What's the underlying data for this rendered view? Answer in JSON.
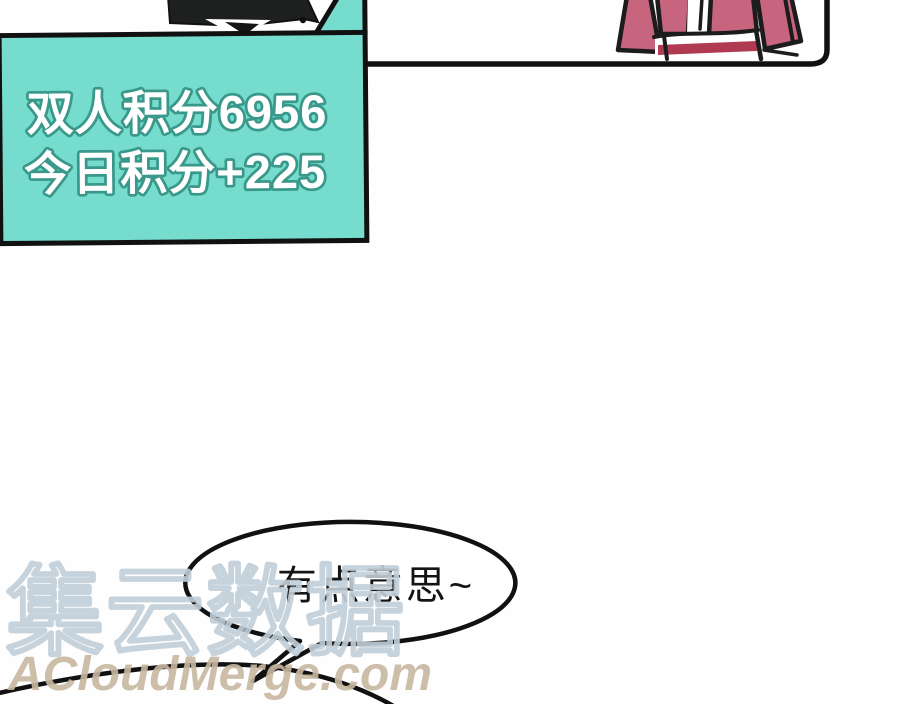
{
  "score_box": {
    "line1": "双人积分6956",
    "line2": "今日积分+225"
  },
  "speech_bubble": {
    "text": "有点意思~"
  },
  "watermark": {
    "brand_cn": "集云数据",
    "site": "ACloudMerge.com"
  },
  "colors": {
    "teal_bg": "#76dcce",
    "teal_outline": "#39988a",
    "ink": "#111111",
    "jacket_pink": "#c7647e",
    "stripe_crimson": "#b03a52",
    "watermark_blue": "#c2cfd9",
    "watermark_tan": "#c8b8a1"
  }
}
